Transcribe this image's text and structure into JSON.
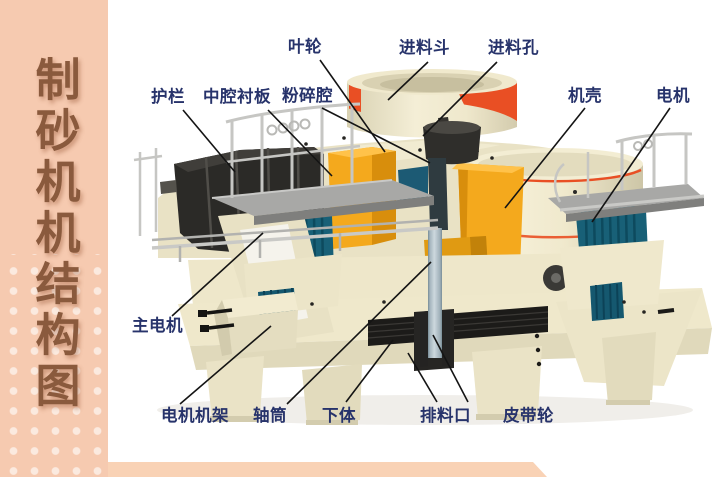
{
  "page": {
    "background": "#ffffff"
  },
  "sidebar": {
    "title": "制砂机机结构图",
    "bg_color": "#f6cab0",
    "text_color": "#8a5a3d"
  },
  "bottom_strip": {
    "color": "#f9d2b5"
  },
  "diagram": {
    "label_color": "#27336b",
    "leader_line_color": "#141414",
    "machine_colors": {
      "body_cream": "#efe8cc",
      "accent_red": "#e94f24",
      "impeller_orange": "#f4a91d",
      "liner_charcoal": "#2b2a27",
      "motor_teal": "#186077",
      "platform_gray": "#a8a8a6",
      "shaft_gray": "#a9bac3",
      "belt_black": "#1c1b19"
    },
    "labels": [
      {
        "text": "叶轮",
        "part": "impeller"
      },
      {
        "text": "进料斗",
        "part": "feed-hopper"
      },
      {
        "text": "进料孔",
        "part": "feed-opening"
      },
      {
        "text": "护栏",
        "part": "guardrail"
      },
      {
        "text": "中腔衬板",
        "part": "cavity-liner-plates"
      },
      {
        "text": "粉碎腔",
        "part": "crushing-chamber"
      },
      {
        "text": "机壳",
        "part": "casing"
      },
      {
        "text": "电机",
        "part": "motor"
      },
      {
        "text": "主电机",
        "part": "main-motor"
      },
      {
        "text": "电机机架",
        "part": "motor-frame"
      },
      {
        "text": "轴筒",
        "part": "shaft-tube"
      },
      {
        "text": "下体",
        "part": "lower-body"
      },
      {
        "text": "排料口",
        "part": "discharge-port"
      },
      {
        "text": "皮带轮",
        "part": "belt-pulley"
      }
    ]
  }
}
